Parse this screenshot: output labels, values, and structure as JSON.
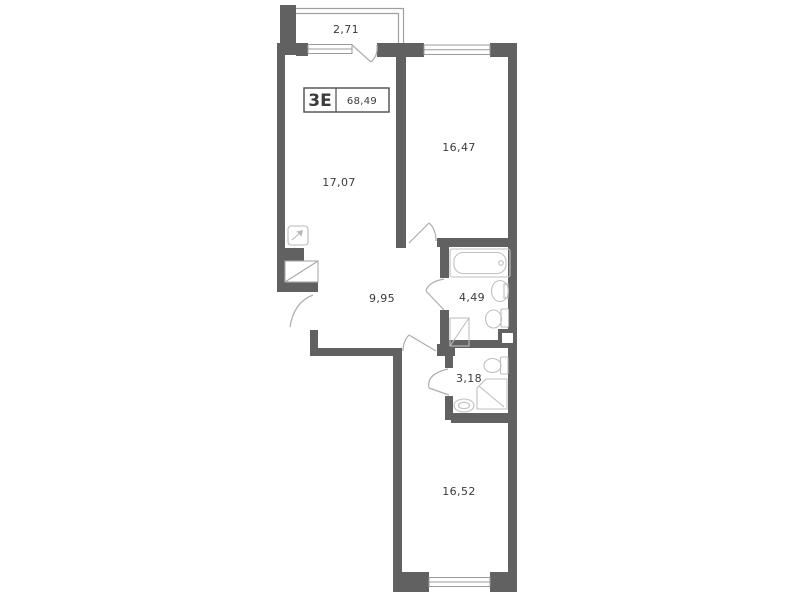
{
  "floor_plan": {
    "apartment_type": "3Е",
    "total_area": "68,49",
    "areas": {
      "balcony": "2,71",
      "living_room": "17,07",
      "bedroom_top": "16,47",
      "hallway": "9,95",
      "bathroom": "4,49",
      "wc": "3,18",
      "bedroom_bottom": "16,52"
    },
    "colors": {
      "wall": "#616161",
      "thin_line": "#a0a0a0",
      "door_line": "#aeaeae",
      "fixture_line": "#bfbfbf",
      "label_text": "#3b3b3b",
      "background": "#ffffff"
    },
    "icons": {
      "vent_shaft": "vent-shaft-icon",
      "bathtub": "bathtub-icon",
      "sink": "sink-icon",
      "toilet": "toilet-icon",
      "washing_machine": "washing-machine-icon",
      "shower": "shower-icon",
      "wardrobe": "wardrobe-niche-icon"
    }
  }
}
